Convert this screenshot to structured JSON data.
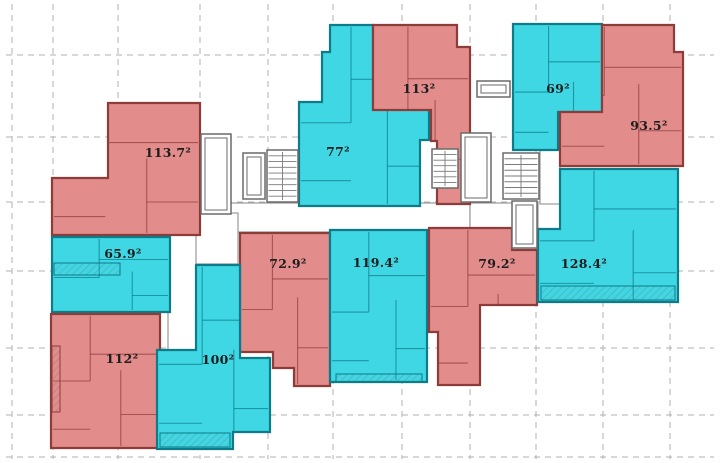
{
  "plan": {
    "canvas": {
      "width": 720,
      "height": 463,
      "background": "#ffffff"
    },
    "palette": {
      "red_fill": "#e28c8c",
      "red_wall": "#8e3c3a",
      "cyan_fill": "#3fd7e4",
      "cyan_wall": "#0d7b88",
      "core_wall": "#6a6a6a",
      "corridor_wall": "#9a9a9a",
      "grid_color": "#b0b0b0",
      "label_color": "#1d1d1d"
    },
    "grid": {
      "vertical_x": [
        12,
        53,
        118,
        200,
        268,
        333,
        402,
        470,
        536,
        603,
        670
      ],
      "horizontal_y": [
        55,
        137,
        202,
        271,
        348,
        415,
        457
      ]
    },
    "units": [
      {
        "id": "unit-113-7",
        "label": "113.7²",
        "area_m2": 113.7,
        "color": "red",
        "label_x": 168,
        "label_y": 157,
        "points": [
          [
            108,
            103
          ],
          [
            200,
            103
          ],
          [
            200,
            235
          ],
          [
            52,
            235
          ],
          [
            52,
            178
          ],
          [
            108,
            178
          ]
        ]
      },
      {
        "id": "unit-77",
        "label": "77²",
        "area_m2": 77,
        "color": "cyan",
        "label_x": 338,
        "label_y": 156,
        "points": [
          [
            330,
            25
          ],
          [
            373,
            25
          ],
          [
            373,
            108
          ],
          [
            429,
            108
          ],
          [
            429,
            140
          ],
          [
            420,
            140
          ],
          [
            420,
            206
          ],
          [
            299,
            206
          ],
          [
            299,
            102
          ],
          [
            322,
            102
          ],
          [
            322,
            52
          ],
          [
            330,
            52
          ]
        ]
      },
      {
        "id": "unit-113",
        "label": "113²",
        "area_m2": 113,
        "color": "red",
        "label_x": 419,
        "label_y": 93,
        "points": [
          [
            373,
            25
          ],
          [
            457,
            25
          ],
          [
            457,
            47
          ],
          [
            470,
            47
          ],
          [
            470,
            204
          ],
          [
            437,
            204
          ],
          [
            437,
            141
          ],
          [
            431,
            141
          ],
          [
            431,
            110
          ],
          [
            373,
            110
          ]
        ]
      },
      {
        "id": "unit-69",
        "label": "69²",
        "area_m2": 69,
        "color": "cyan",
        "label_x": 558,
        "label_y": 93,
        "points": [
          [
            513,
            24
          ],
          [
            602,
            24
          ],
          [
            602,
            112
          ],
          [
            558,
            112
          ],
          [
            558,
            150
          ],
          [
            513,
            150
          ]
        ]
      },
      {
        "id": "unit-93-5",
        "label": "93.5²",
        "area_m2": 93.5,
        "color": "red",
        "label_x": 649,
        "label_y": 130,
        "points": [
          [
            602,
            25
          ],
          [
            674,
            25
          ],
          [
            674,
            52
          ],
          [
            683,
            52
          ],
          [
            683,
            166
          ],
          [
            560,
            166
          ],
          [
            560,
            112
          ],
          [
            602,
            112
          ]
        ]
      },
      {
        "id": "unit-65-9",
        "label": "65.9²",
        "area_m2": 65.9,
        "color": "cyan",
        "label_x": 123,
        "label_y": 258,
        "points": [
          [
            52,
            237
          ],
          [
            170,
            237
          ],
          [
            170,
            312
          ],
          [
            52,
            312
          ]
        ]
      },
      {
        "id": "unit-72-9",
        "label": "72.9²",
        "area_m2": 72.9,
        "color": "red",
        "label_x": 288,
        "label_y": 268,
        "points": [
          [
            240,
            233
          ],
          [
            330,
            233
          ],
          [
            330,
            386
          ],
          [
            294,
            386
          ],
          [
            294,
            368
          ],
          [
            273,
            368
          ],
          [
            273,
            352
          ],
          [
            240,
            352
          ]
        ]
      },
      {
        "id": "unit-119-4",
        "label": "119.4²",
        "area_m2": 119.4,
        "color": "cyan",
        "label_x": 376,
        "label_y": 267,
        "points": [
          [
            330,
            230
          ],
          [
            427,
            230
          ],
          [
            427,
            382
          ],
          [
            330,
            382
          ]
        ]
      },
      {
        "id": "unit-79-2",
        "label": "79.2²",
        "area_m2": 79.2,
        "color": "red",
        "label_x": 497,
        "label_y": 268,
        "points": [
          [
            429,
            228
          ],
          [
            512,
            228
          ],
          [
            512,
            250
          ],
          [
            537,
            250
          ],
          [
            537,
            305
          ],
          [
            480,
            305
          ],
          [
            480,
            385
          ],
          [
            438,
            385
          ],
          [
            438,
            332
          ],
          [
            429,
            332
          ]
        ]
      },
      {
        "id": "unit-128-4",
        "label": "128.4²",
        "area_m2": 128.4,
        "color": "cyan",
        "label_x": 584,
        "label_y": 268,
        "points": [
          [
            560,
            169
          ],
          [
            678,
            169
          ],
          [
            678,
            302
          ],
          [
            538,
            302
          ],
          [
            538,
            229
          ],
          [
            560,
            229
          ]
        ]
      },
      {
        "id": "unit-112",
        "label": "112²",
        "area_m2": 112,
        "color": "red",
        "label_x": 122,
        "label_y": 363,
        "points": [
          [
            51,
            314
          ],
          [
            160,
            314
          ],
          [
            160,
            448
          ],
          [
            51,
            448
          ]
        ]
      },
      {
        "id": "unit-100",
        "label": "100²",
        "area_m2": 100,
        "color": "cyan",
        "label_x": 218,
        "label_y": 364,
        "points": [
          [
            196,
            265
          ],
          [
            240,
            265
          ],
          [
            240,
            358
          ],
          [
            270,
            358
          ],
          [
            270,
            432
          ],
          [
            233,
            432
          ],
          [
            233,
            449
          ],
          [
            157,
            449
          ],
          [
            157,
            350
          ],
          [
            196,
            350
          ]
        ]
      }
    ],
    "corridors": [
      {
        "id": "corridor-main",
        "x": 170,
        "y": 203,
        "w": 300,
        "h": 29
      },
      {
        "id": "corridor-left",
        "x": 170,
        "y": 213,
        "w": 68,
        "h": 51
      },
      {
        "id": "corridor-entry",
        "x": 168,
        "y": 232,
        "w": 28,
        "h": 118
      },
      {
        "id": "corridor-right",
        "x": 470,
        "y": 203,
        "w": 68,
        "h": 29
      },
      {
        "id": "corridor-right-wing",
        "x": 540,
        "y": 114,
        "w": 20,
        "h": 90
      }
    ],
    "cores": [
      {
        "id": "elevator-core-left",
        "type": "shaft",
        "x": 201,
        "y": 134,
        "w": 30,
        "h": 80
      },
      {
        "id": "elevator-core-a",
        "type": "shaft",
        "x": 243,
        "y": 153,
        "w": 22,
        "h": 46
      },
      {
        "id": "stair-core-a",
        "type": "stair",
        "x": 267,
        "y": 150,
        "w": 31,
        "h": 52,
        "treads": 8
      },
      {
        "id": "stair-core-b",
        "type": "stair",
        "x": 432,
        "y": 149,
        "w": 26,
        "h": 39,
        "treads": 6
      },
      {
        "id": "elevator-core-b",
        "type": "shaft",
        "x": 461,
        "y": 133,
        "w": 30,
        "h": 69
      },
      {
        "id": "stair-core-c",
        "type": "stair",
        "x": 503,
        "y": 153,
        "w": 36,
        "h": 46,
        "treads": 7
      },
      {
        "id": "elevator-core-c",
        "type": "shaft",
        "x": 512,
        "y": 201,
        "w": 25,
        "h": 47
      },
      {
        "id": "roof-shaft",
        "type": "shaft",
        "x": 477,
        "y": 81,
        "w": 33,
        "h": 16
      }
    ],
    "loggias": [
      {
        "id": "loggia-65-9",
        "x": 54,
        "y": 263,
        "w": 66,
        "h": 12,
        "tone": "cyan"
      },
      {
        "id": "loggia-112",
        "x": 52,
        "y": 346,
        "w": 8,
        "h": 66,
        "tone": "red"
      },
      {
        "id": "loggia-119-4",
        "x": 336,
        "y": 374,
        "w": 86,
        "h": 8,
        "tone": "cyan"
      },
      {
        "id": "loggia-100",
        "x": 160,
        "y": 433,
        "w": 70,
        "h": 14,
        "tone": "cyan"
      },
      {
        "id": "loggia-128-4",
        "x": 541,
        "y": 286,
        "w": 134,
        "h": 14,
        "tone": "cyan"
      }
    ]
  }
}
